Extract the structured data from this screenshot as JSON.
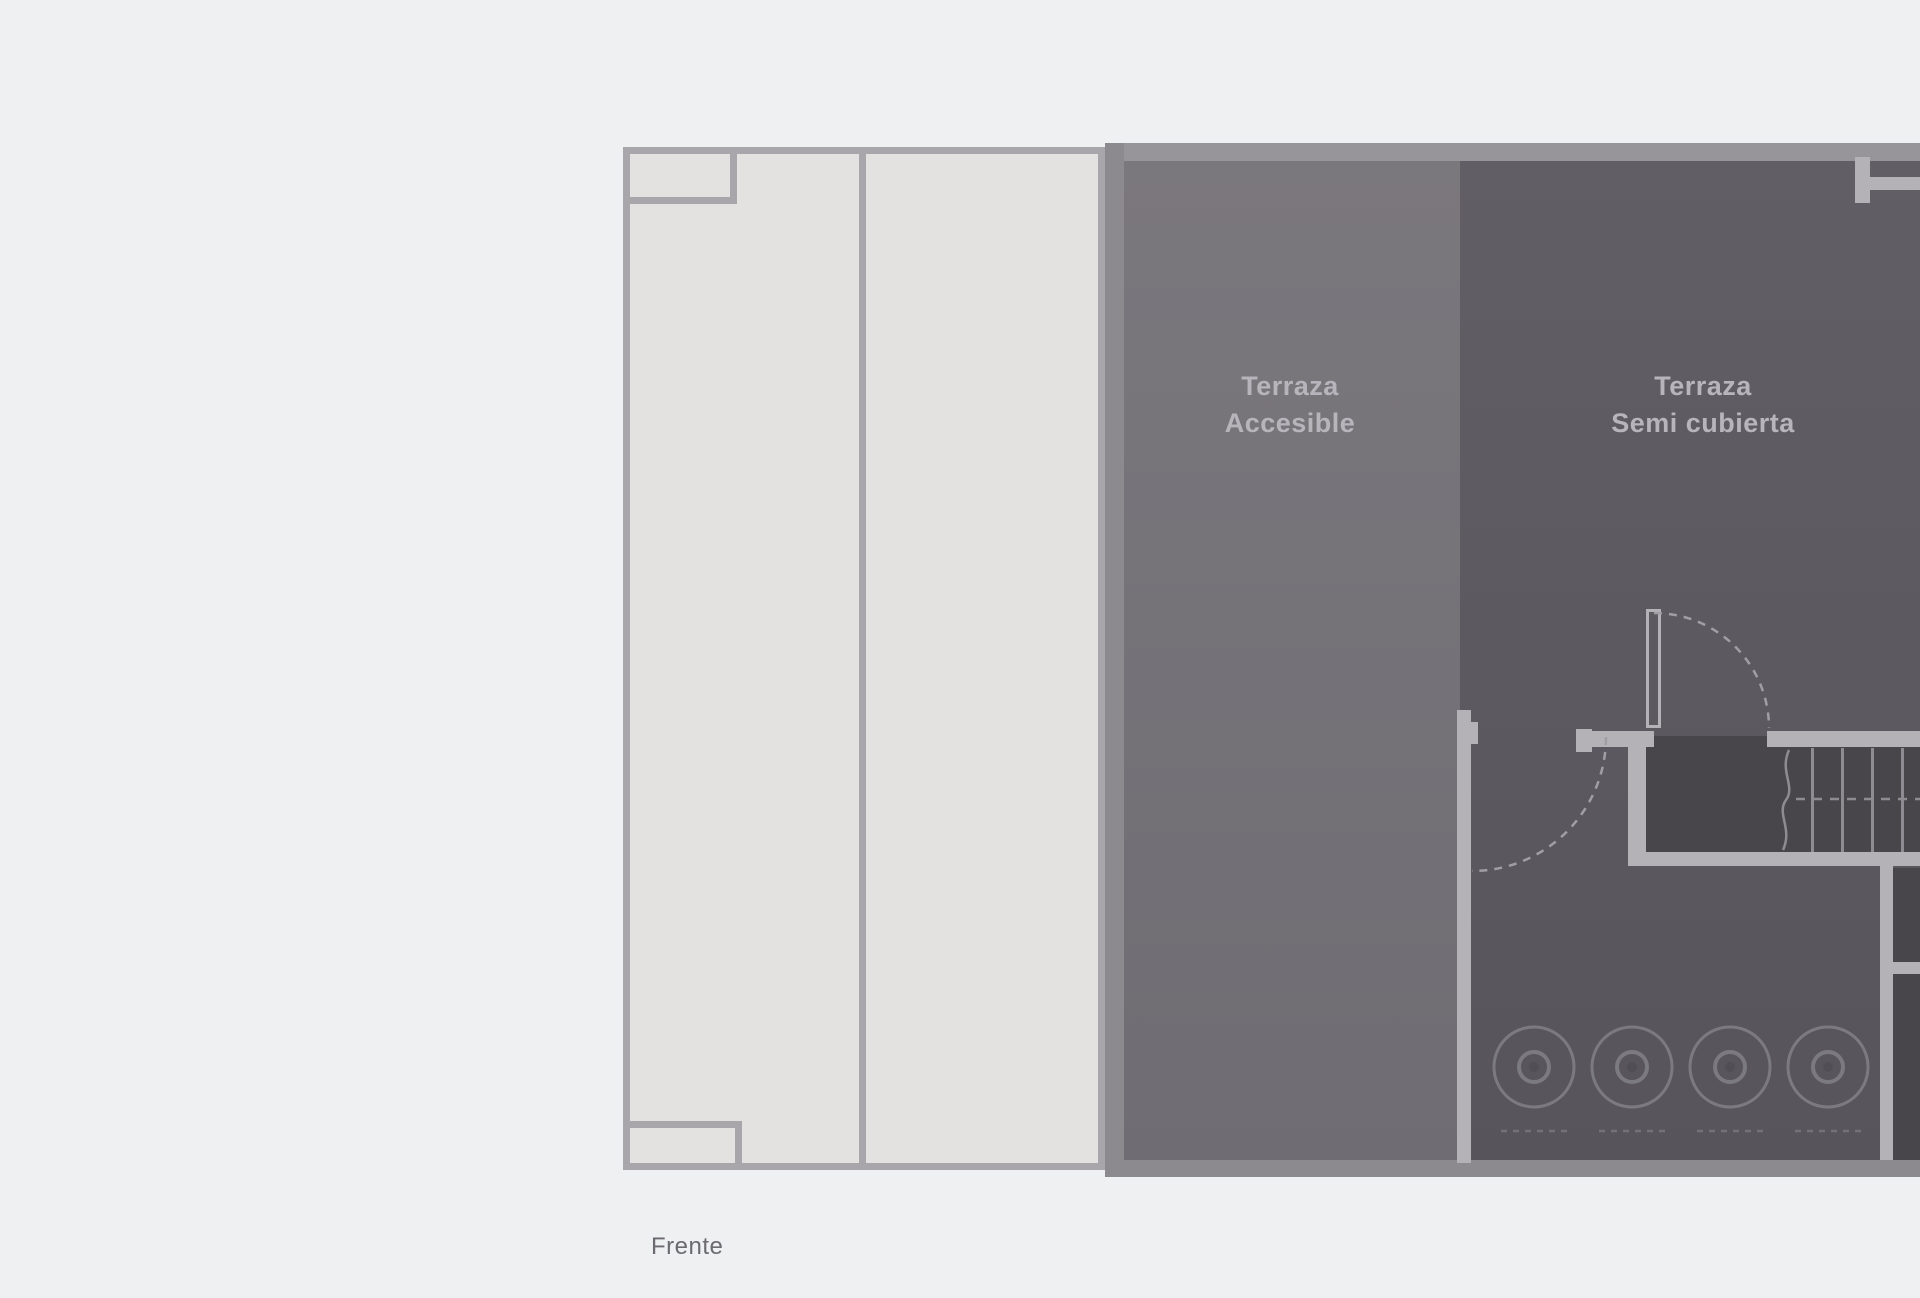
{
  "page": {
    "front_label": "Frente"
  },
  "plan": {
    "rooms": {
      "accesible": {
        "line1": "Terraza",
        "line2": "Accesible"
      },
      "semi": {
        "line1": "Terraza",
        "line2": "Semi cubierta"
      }
    },
    "fixtures": {
      "burner_count": 4,
      "stair_tread_count": 4,
      "door_count": 2
    }
  },
  "colors": {
    "page_bg": "#eef0f2",
    "patio_fill": "#e3e2e1",
    "patio_line": "#a8a6aa",
    "wall_top": "#97959a",
    "wall_side": "#8c8a8e",
    "room_accesible_top": "#7a777d",
    "room_accesible_bottom": "#6f6d73",
    "room_semi_top": "#615f65",
    "room_semi_bottom": "#57555b",
    "void_fill": "#48464b",
    "light_wall": "#b4b2b6",
    "tread_line": "#8e8c92",
    "arc_dash": "#a09ea5",
    "circle_line": "#7c7a81",
    "under_dash": "#747279",
    "burner_center": "#514f55",
    "label_text": "#b7b5bb",
    "front_text": "#6c6a70"
  }
}
